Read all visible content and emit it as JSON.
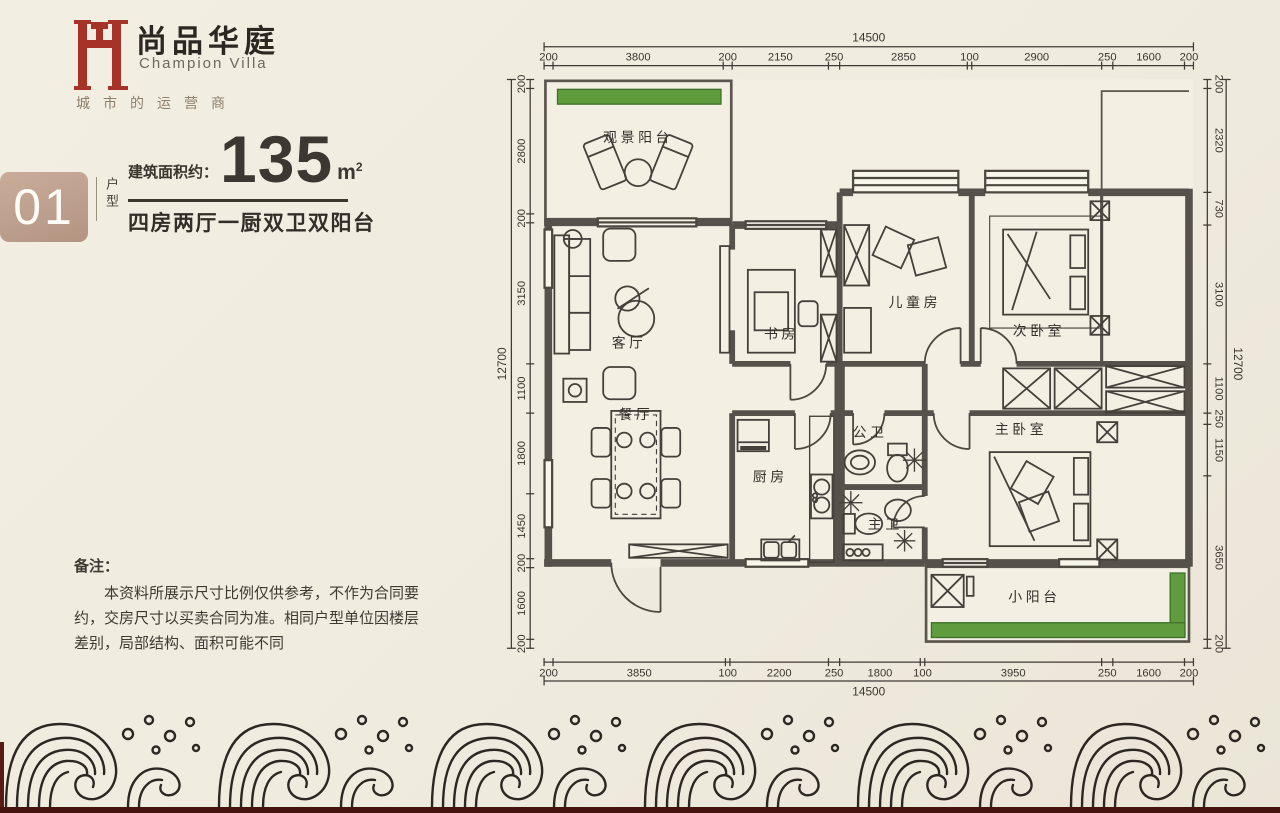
{
  "brand": {
    "name_cn": "尚品华庭",
    "name_en": "Champion Villa",
    "tagline": "城市的运营商"
  },
  "unit": {
    "number": "01",
    "number_label": "户型",
    "area_prefix": "建筑面积约：",
    "area_value": "135",
    "area_unit_base": "m",
    "area_unit_sup": "2",
    "layout_summary": "四房两厅一厨双卫双阳台"
  },
  "notes": {
    "title": "备注：",
    "body": "本资料所展示尺寸比例仅供参考，不作为合同要约，交房尺寸以买卖合同为准。相同户型单位因楼层差别，局部结构、面积可能不同"
  },
  "floor_plan": {
    "rooms": [
      {
        "name": "观景阳台",
        "x": 2100,
        "y": 1400
      },
      {
        "name": "客厅",
        "x": 1900,
        "y": 5980
      },
      {
        "name": "书房",
        "x": 5300,
        "y": 5780
      },
      {
        "name": "儿童房",
        "x": 8280,
        "y": 5080
      },
      {
        "name": "次卧室",
        "x": 11050,
        "y": 5720
      },
      {
        "name": "餐厅",
        "x": 2050,
        "y": 7580
      },
      {
        "name": "厨房",
        "x": 5050,
        "y": 8980
      },
      {
        "name": "公卫",
        "x": 7280,
        "y": 7980
      },
      {
        "name": "主卫",
        "x": 7620,
        "y": 10040
      },
      {
        "name": "主卧室",
        "x": 10650,
        "y": 7920
      },
      {
        "name": "小阳台",
        "x": 10950,
        "y": 11660
      }
    ],
    "dimensions": {
      "top": {
        "total": "14500",
        "segments": [
          200,
          3800,
          200,
          2150,
          250,
          2850,
          100,
          2900,
          250,
          1600,
          200
        ]
      },
      "bottom": {
        "total": "14500",
        "segments": [
          200,
          3850,
          100,
          2200,
          250,
          1800,
          100,
          3950,
          250,
          1600,
          200
        ]
      },
      "left": {
        "total": "12700",
        "segments": [
          200,
          2800,
          200,
          3150,
          1100,
          1800,
          1450,
          200,
          1600,
          200
        ]
      },
      "right": {
        "total": "12700",
        "segments": [
          200,
          2320,
          730,
          3100,
          1100,
          250,
          1150,
          3650,
          200
        ]
      }
    }
  },
  "colors": {
    "accent_red": "#a63228",
    "badge_tan": "#bfa28f",
    "planter_green": "#5e9c3d",
    "wall_gray": "#56514a",
    "background": "#efebdf"
  }
}
